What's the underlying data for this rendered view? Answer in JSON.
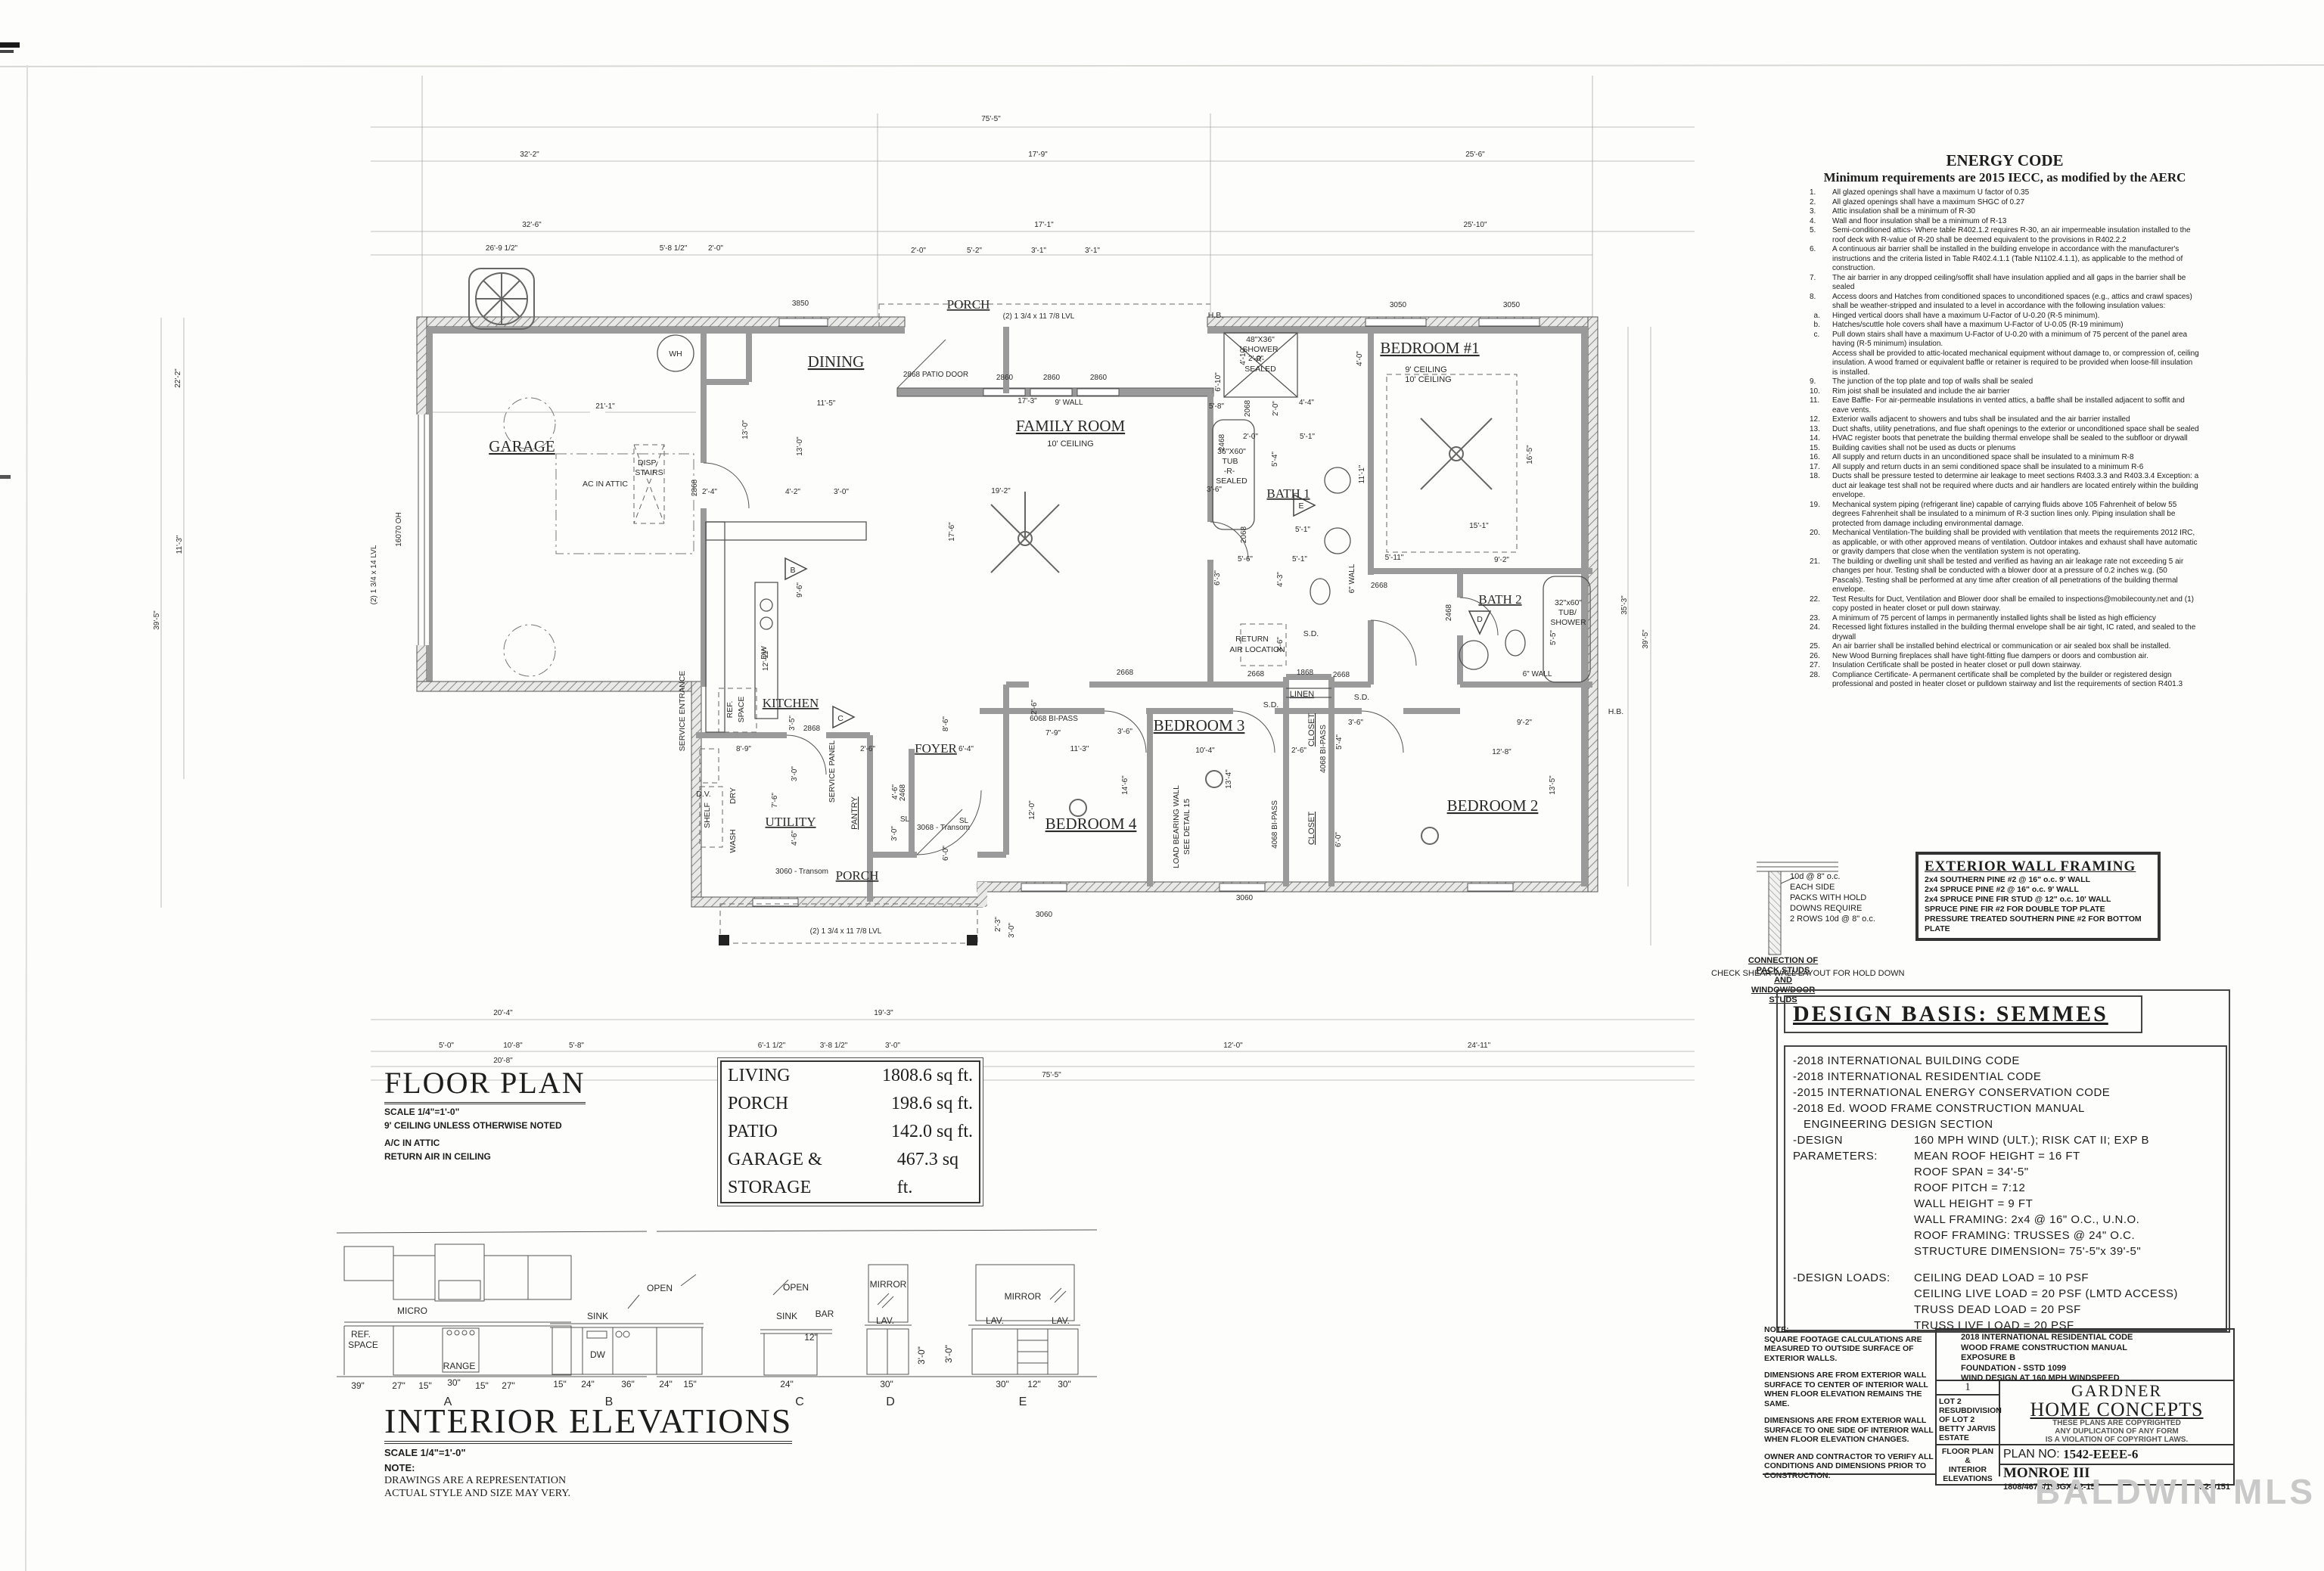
{
  "sheet": {
    "watermark": "BALDWIN MLS"
  },
  "plan": {
    "labels": {
      "garage": "GARAGE",
      "dining": "DINING",
      "family": "FAMILY ROOM",
      "family_sub": "10' CEILING",
      "porch_top": "PORCH",
      "kitchen": "KITCHEN",
      "utility": "UTILITY",
      "pantry": "PANTRY",
      "foyer": "FOYER",
      "porch_bottom": "PORCH",
      "bed1": "BEDROOM #1",
      "bed1_sub1": "9' CEILING",
      "bed1_sub2": "10' CEILING",
      "bath1": "BATH 1",
      "bath2": "BATH 2",
      "bed2": "BEDROOM 2",
      "bed3": "BEDROOM 3",
      "bed4": "BEDROOM 4",
      "linen": "LINEN",
      "closet1": "CLOSET",
      "closet2": "CLOSET",
      "wh": "WH",
      "disp1": "DISP.",
      "disp2": "STAIRS",
      "ac": "AC IN ATTIC",
      "ref1": "REF.",
      "ref2": "SPACE",
      "shelf": "SHELF",
      "dry": "DRY",
      "wash": "WASH",
      "service_panel": "SERVICE PANEL",
      "service_entrance": "SERVICE ENTRANCE",
      "dv": "D.V.",
      "return1": "RETURN",
      "return2": "AIR LOCATION",
      "lb1": "LOAD BEARING WALL",
      "lb2": "SEE DETAIL 15",
      "hb1": "H.B.",
      "hb2": "H.B.",
      "sh1": "48\"X36\"",
      "sh2": "SHOWER",
      "sh3": "-R-",
      "sh4": "SEALED",
      "tb1": "36\"X60\"",
      "tb2": "TUB",
      "tb3": "-R-",
      "tb4": "SEALED",
      "ts1": "32\"x60\"",
      "ts2": "TUB/",
      "ts3": "SHOWER",
      "sd1": "S.D.",
      "sd2": "S.D.",
      "sd3": "S.D.",
      "dw": "DW",
      "triB": "B",
      "triC": "C",
      "triD": "D",
      "triE": "E"
    },
    "dims": [
      "75'-5\"",
      "32'-2\"",
      "17'-9\"",
      "25'-6\"",
      "32'-6\"",
      "17'-1\"",
      "25'-10\"",
      "26'-9 1/2\"",
      "5'-8 1/2\"",
      "2'-0\"",
      "2'-0\"",
      "5'-2\"",
      "3'-1\"",
      "3'-1\"",
      "21'-1\"",
      "13'-0\"",
      "2'-4\"",
      "11'-5\"",
      "13'-0\"",
      "19'-2\"",
      "17'-6\"",
      "17'-3\"",
      "4'-2\"",
      "3'-0\"",
      "9'-6\"",
      "4'-0\"",
      "11'-1\"",
      "16'-5\"",
      "15'-1\"",
      "9'-2\"",
      "5'-11\"",
      "12'-8\"",
      "9'-2\"",
      "13'-5\"",
      "5'-5\"",
      "35'-3\"",
      "39'-5\"",
      "11'-3\"",
      "7'-9\"",
      "2'-6\"",
      "12'-0\"",
      "14'-6\"",
      "10'-4\"",
      "13'-4\"",
      "3'-6\"",
      "3'-6\"",
      "5'-4\"",
      "6'-0\"",
      "2'-6\"",
      "8'-9\"",
      "7'-6\"",
      "3'-0\"",
      "3'-5\"",
      "4'-6\"",
      "4'-6\"",
      "3'-0\"",
      "6'-4\"",
      "8'-6\"",
      "6'-0\"",
      "12'-11\"",
      "2'-6\"",
      "2'-3\"",
      "3'-0\"",
      "20'-4\"",
      "19'-3\"",
      "5'-0\"",
      "10'-8\"",
      "5'-8\"",
      "6'-1 1/2\"",
      "3'-8 1/2\"",
      "3'-0\"",
      "12'-0\"",
      "24'-11\"",
      "20'-8\"",
      "11'-10\"",
      "6'-0\"",
      "75'-5\"",
      "22'-2\"",
      "39'-5\"",
      "11'-3\"",
      "4'-10\"",
      "4'-4\"",
      "2'-0\"",
      "5'-1\"",
      "2'-0\"",
      "5'-4\"",
      "5'-1\"",
      "5'-1\"",
      "4'-3\"",
      "5'-6\"",
      "6'-3\"",
      "6'-10\"",
      "5'-8\"",
      "3'-6\"",
      "3'-6\"",
      "2'-0\""
    ],
    "tags": [
      "3850",
      "3050",
      "3050",
      "2868 PATIO DOOR",
      "2860",
      "2860",
      "2860",
      "(2) 1 3/4 x 11 7/8 LVL",
      "(2) 1 3/4 x 14 LVL",
      "2868",
      "2868",
      "2468",
      "2468",
      "2468",
      "2068",
      "2068",
      "2668",
      "2668",
      "2668",
      "2668",
      "1868",
      "6068 BI-PASS",
      "4068 BI-PASS",
      "4068 BI-PASS",
      "3060 - Transom",
      "3068 - Transom",
      "3060",
      "3060",
      "(2) 1 3/4 x 11 7/8 LVL",
      "SL",
      "SL",
      "9' WALL",
      "6\" WALL",
      "6\" WALL",
      "16070 OH"
    ]
  },
  "floor_plan_block": {
    "title": "FLOOR PLAN",
    "scale": "SCALE 1/4\"=1'-0\"",
    "note1": "9' CEILING UNLESS OTHERWISE NOTED",
    "note2": "A/C IN ATTIC",
    "note3": "RETURN AIR IN CEILING"
  },
  "area_table": {
    "rows": [
      {
        "name": "LIVING",
        "value": "1808.6 sq ft."
      },
      {
        "name": "PORCH",
        "value": "198.6 sq ft."
      },
      {
        "name": "PATIO",
        "value": "142.0 sq ft."
      },
      {
        "name": "GARAGE & STORAGE",
        "value": "467.3 sq ft."
      }
    ]
  },
  "energy_code": {
    "title": "ENERGY CODE",
    "subtitle": "Minimum requirements are 2015 IECC, as modified by the AERC",
    "items": [
      {
        "n": "1.",
        "t": "All glazed openings shall have a maximum U factor of 0.35"
      },
      {
        "n": "2.",
        "t": "All glazed openings shall have a maximum SHGC of 0.27"
      },
      {
        "n": "3.",
        "t": "Attic insulation shall be a minimum of R-30"
      },
      {
        "n": "4.",
        "t": "Wall and floor insulation shall be a minimum of R-13"
      },
      {
        "n": "5.",
        "t": "Semi-conditioned attics- Where table R402.1.2 requires R-30, an air impermeable insulation installed to the roof deck with R-value of R-20 shall be deemed equivalent to the provisions in R402.2.2"
      },
      {
        "n": "6.",
        "t": "A continuous air barrier shall be installed in the building envelope in accordance with the manufacturer's instructions and the criteria listed in Table R402.4.1.1 (Table N1102.4.1.1), as applicable to the method of construction."
      },
      {
        "n": "7.",
        "t": "The air barrier in any dropped ceiling/soffit shall have insulation applied and all gaps in the barrier shall be sealed"
      },
      {
        "n": "8.",
        "t": "Access doors and Hatches from conditioned spaces to unconditioned spaces (e.g., attics and crawl spaces) shall be weather-stripped and insulated to a level in accordance with the following insulation values:"
      },
      {
        "n": "  a.",
        "t": "Hinged vertical doors shall have a maximum U-Factor of U-0.20 (R-5 minimum)."
      },
      {
        "n": "  b.",
        "t": "Hatches/scuttle hole covers shall have a maximum U-Factor of U-0.05 (R-19 minimum)"
      },
      {
        "n": "  c.",
        "t": "Pull down stairs shall have a maximum U-Factor of U-0.20 with a minimum of 75 percent of the panel area having (R-5 minimum) insulation."
      },
      {
        "n": "",
        "t": "Access shall be provided to attic-located mechanical equipment without damage to, or compression of, ceiling insulation. A wood framed or equivalent baffle or retainer is required to be provided when loose-fill insulation is installed."
      },
      {
        "n": "9.",
        "t": "The junction of the top plate and top of walls shall be sealed"
      },
      {
        "n": "10.",
        "t": "Rim joist shall be insulated and include the air barrier"
      },
      {
        "n": "11.",
        "t": "Eave Baffle- For air-permeable insulations in vented attics, a baffle shall be installed adjacent to soffit and eave vents."
      },
      {
        "n": "12.",
        "t": "Exterior walls adjacent to showers and tubs shall be insulated and the air barrier installed"
      },
      {
        "n": "13.",
        "t": "Duct shafts, utility penetrations, and flue shaft openings to the exterior or unconditioned space shall be sealed"
      },
      {
        "n": "14.",
        "t": "HVAC register boots that penetrate the building thermal envelope shall be sealed to the subfloor or drywall"
      },
      {
        "n": "15.",
        "t": "Building cavities shall not be used as ducts or plenums"
      },
      {
        "n": "16.",
        "t": "All supply and return ducts in an unconditioned space shall be insulated to a minimum R-8"
      },
      {
        "n": "17.",
        "t": "All supply and return ducts in an semi conditioned space shall be insulated to a minimum R-6"
      },
      {
        "n": "18.",
        "t": "Ducts shall be pressure tested to determine air leakage to meet sections R403.3.3 and R403.3.4 Exception: a duct air leakage test shall not be required where ducts and air handlers are located entirely within the building envelope."
      },
      {
        "n": "19.",
        "t": "Mechanical system piping (refrigerant line) capable of carrying fluids above 105 Fahrenheit of below 55 degrees Fahrenheit shall be insulated to a minimum of R-3 suction lines only. Piping insulation shall be protected from damage including environmental damage."
      },
      {
        "n": "20.",
        "t": "Mechanical Ventilation-The building shall be provided with ventilation that meets the requirements 2012 IRC, as applicable, or with other approved means of ventilation. Outdoor intakes and exhaust shall have automatic or gravity dampers that close when the ventilation system is not operating."
      },
      {
        "n": "21.",
        "t": "The building or dwelling unit shall be tested and verified as having an air leakage rate not exceeding 5 air changes per hour. Testing shall be conducted with a blower door at a pressure of 0.2 inches w.g. (50 Pascals). Testing shall be performed at any time after creation of all penetrations of the building thermal envelope."
      },
      {
        "n": "22.",
        "t": "Test Results for Duct, Ventilation and Blower door shall be emailed to inspections@mobilecounty.net and (1) copy posted in heater closet or pull down stairway."
      },
      {
        "n": "23.",
        "t": "A minimum of 75 percent of lamps in permanently installed lights shall be listed as high efficiency"
      },
      {
        "n": "24.",
        "t": "Recessed light fixtures installed in the building thermal envelope shall be air tight, IC rated, and sealed to the drywall"
      },
      {
        "n": "25.",
        "t": "An air barrier shall be installed behind electrical or communication or air sealed box shall be installed."
      },
      {
        "n": "26.",
        "t": "New Wood Burning fireplaces shall have tight-fitting flue dampers or doors and combustion air."
      },
      {
        "n": "27.",
        "t": "Insulation Certificate shall be posted in heater closet or pull down stairway."
      },
      {
        "n": "28.",
        "t": "Compliance Certificate- A permanent certificate shall be completed by the builder or registered design professional and posted in heater closet or pulldown stairway and list the requirements of section R401.3"
      }
    ]
  },
  "framing": {
    "title": "EXTERIOR WALL FRAMING",
    "lines": [
      "2x4 SOUTHERN PINE #2 @ 16\" o.c. 9' WALL",
      "2x4 SPRUCE PINE #2 @ 16\" o.c. 9' WALL",
      "2x4 SPRUCE PINE FIR STUD @ 12\" o.c. 10' WALL",
      "SPRUCE PINE FIR #2 FOR DOUBLE TOP PLATE",
      "PRESSURE TREATED SOUTHERN PINE #2 FOR BOTTOM PLATE"
    ]
  },
  "pack_studs": {
    "lines": [
      "10d @ 8\" o.c.",
      "EACH SIDE",
      "PACKS WITH HOLD",
      "DOWNS REQUIRE",
      "2 ROWS 10d @ 8\" o.c."
    ],
    "caption": [
      "CONNECTION OF",
      "PACK STUDS",
      "AND",
      "WINDOW/DOOR",
      "STUDS"
    ],
    "check": "CHECK SHEAR WALL LAYOUT FOR HOLD DOWN"
  },
  "design_basis": {
    "title": "DESIGN BASIS: SEMMES",
    "codes": [
      "-2018 INTERNATIONAL BUILDING CODE",
      "-2018 INTERNATIONAL RESIDENTIAL CODE",
      "-2015 INTERNATIONAL ENERGY CONSERVATION CODE",
      "-2018 Ed. WOOD FRAME CONSTRUCTION MANUAL",
      "   ENGINEERING DESIGN SECTION"
    ],
    "params_label": "-DESIGN PARAMETERS:",
    "params": [
      "160 MPH WIND (ULT.); RISK CAT II; EXP B",
      "MEAN ROOF HEIGHT = 16 FT",
      "ROOF SPAN = 34'-5\"",
      "ROOF PITCH = 7:12",
      "WALL HEIGHT = 9 FT",
      "WALL FRAMING: 2x4 @ 16\" O.C., U.N.O.",
      "ROOF FRAMING: TRUSSES @ 24\" O.C.",
      "STRUCTURE DIMENSION= 75'-5\"x 39'-5\""
    ],
    "loads_label": "-DESIGN LOADS:",
    "loads": [
      "CEILING DEAD LOAD = 10 PSF",
      "CEILING LIVE LOAD = 20 PSF (LMTD ACCESS)",
      "TRUSS DEAD LOAD = 20 PSF",
      "TRUSS LIVE LOAD = 20 PSF"
    ]
  },
  "title_block": {
    "note_paras": [
      "NOTE:\nSQUARE FOOTAGE CALCULATIONS ARE MEASURED TO OUTSIDE SURFACE OF EXTERIOR WALLS.",
      "DIMENSIONS ARE FROM EXTERIOR WALL SURFACE TO CENTER OF INTERIOR WALL WHEN FLOOR ELEVATION REMAINS THE SAME.",
      "DIMENSIONS ARE FROM EXTERIOR WALL SURFACE TO ONE SIDE OF INTERIOR WALL WHEN FLOOR ELEVATION CHANGES.",
      "OWNER AND CONTRACTOR TO VERIFY ALL CONDITIONS AND DIMENSIONS PRIOR TO CONSTRUCTION."
    ],
    "codes": [
      "2018 INTERNATIONAL RESIDENTIAL CODE",
      "WOOD FRAME CONSTRUCTION MANUAL",
      "EXPOSURE B",
      "FOUNDATION - SSTD 1099",
      "WIND DESIGN AT 160 MPH  WINDSPEED"
    ],
    "sheet_no": "1",
    "lot_lines": [
      "LOT 2",
      "RESUBDIVISION",
      "OF LOT 2",
      "BETTY JARVIS",
      "ESTATE"
    ],
    "sheet_title_lines": [
      "FLOOR PLAN",
      "&",
      "INTERIOR",
      "ELEVATIONS"
    ],
    "company1": "GARDNER",
    "company2": "HOME CONCEPTS",
    "copyright": [
      "THESE PLANS ARE COPYRIGHTED",
      "ANY DUPLICATION OF ANY FORM",
      "IS A VIOLATION OF COPYRIGHT LAWS."
    ],
    "plan_no_label": "PLAN  NO:",
    "plan_no": "1542-EEEE-6",
    "model": "MONROE III",
    "job_code": "1808/467S/198GX4/2-157",
    "phone": "422-9151"
  },
  "interior_elevations": {
    "title": "INTERIOR ELEVATIONS",
    "scale": "SCALE 1/4\"=1'-0\"",
    "note1": "NOTE:",
    "note2": "DRAWINGS ARE A REPRESENTATION",
    "note3": "ACTUAL STYLE AND SIZE MAY VERY.",
    "a": {
      "label": "A",
      "ref1": "REF.",
      "ref2": "SPACE",
      "micro": "MICRO",
      "range": "RANGE",
      "dims": [
        "39\"",
        "27\"",
        "15\"",
        "30\"",
        "15\"",
        "27\""
      ]
    },
    "b": {
      "label": "B",
      "open": "OPEN",
      "sink": "SINK",
      "dw": "DW",
      "dims": [
        "15\"",
        "24\"",
        "36\"",
        "24\"",
        "15\""
      ]
    },
    "c": {
      "label": "C",
      "open": "OPEN",
      "sink": "SINK",
      "bar": "BAR",
      "d12": "12\"",
      "d24": "24\""
    },
    "d": {
      "label": "D",
      "mirror": "MIRROR",
      "lav": "LAV.",
      "h": "3'-0\"",
      "w": "30\""
    },
    "e": {
      "label": "E",
      "mirror": "MIRROR",
      "lav1": "LAV.",
      "lav2": "LAV.",
      "h": "3'-0\"",
      "dims": [
        "30\"",
        "12\"",
        "30\""
      ]
    }
  }
}
